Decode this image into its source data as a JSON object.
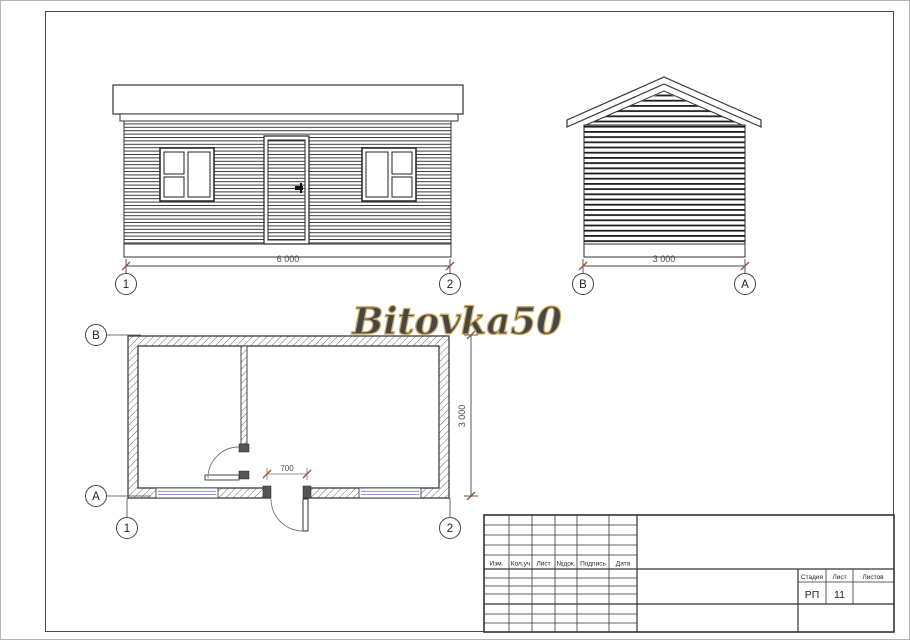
{
  "watermark": {
    "text": "Bitovka50"
  },
  "dims": {
    "width": "6 000",
    "depth": "3 000",
    "depth_plan": "3 000",
    "door_width": "700"
  },
  "axes": {
    "n1": "1",
    "n2": "2",
    "a": "A",
    "b": "B"
  },
  "title_block": {
    "rev_headers": [
      "Изм.",
      "Кол.уч",
      "Лист",
      "№док.",
      "Подпись",
      "Дата"
    ],
    "stage_label": "Стадия",
    "sheet_label": "Лист",
    "sheets_label": "Листов",
    "stage": "РП",
    "sheet": "11",
    "sheets": ""
  },
  "colors": {
    "dim_tick": "#9b4f38",
    "glazing": "#8080cc",
    "watermark_fill": "#f5e9c4",
    "watermark_stroke": "#c8a352",
    "outline": "#333333"
  }
}
